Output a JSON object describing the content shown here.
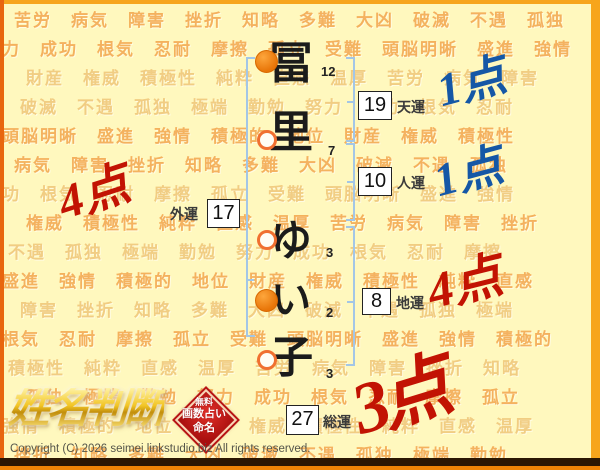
{
  "chart": {
    "characters": [
      {
        "glyph": "冨",
        "strokes": "12",
        "marker": "filled"
      },
      {
        "glyph": "里",
        "strokes": "7",
        "marker": "hollow"
      },
      {
        "glyph": "ゆ",
        "strokes": "3",
        "marker": "hollow"
      },
      {
        "glyph": "い",
        "strokes": "2",
        "marker": "filled"
      },
      {
        "glyph": "子",
        "strokes": "3",
        "marker": "hollow"
      }
    ],
    "fortunes": [
      {
        "key": "tenun",
        "label": "天運",
        "value": "19",
        "score": "1点",
        "score_color": "blue"
      },
      {
        "key": "jinun",
        "label": "人運",
        "value": "10",
        "score": "1点",
        "score_color": "blue"
      },
      {
        "key": "gaiun",
        "label": "外運",
        "value": "17",
        "score": "4点",
        "score_color": "red"
      },
      {
        "key": "chiun",
        "label": "地運",
        "value": "8",
        "score": "4点",
        "score_color": "red"
      },
      {
        "key": "soun",
        "label": "総運",
        "value": "27",
        "score": "3点",
        "score_color": "red"
      }
    ]
  },
  "branding": {
    "logo_text": "姓名判断",
    "seal_lines": [
      "無料",
      "画数占い",
      "命名"
    ]
  },
  "footer": {
    "copyright": "Copyright (C) 2026 seimei.linkstudio.biz All rights reserved."
  },
  "colors": {
    "score_red": "#C21303",
    "score_blue": "#1557A6",
    "bracket_blue": "#A3C6E6",
    "marker_orange": "#E87508",
    "seal_red": "#B81414",
    "logo_gold": "#E8B91C",
    "background": "#FFF8BE"
  },
  "background_words": {
    "rows": [
      "苦労　病気　障害　挫折　知略　多難　大凶　破滅　不遇　孤独",
      "力　成功　根気　忍耐　摩擦　孤立　受難　頭脳明晰　盛進　強情",
      "財産　権威　積極性　純粋　直感　温厚　苦労　病気　障害",
      "破滅　不遇　孤独　極端　勤勉　努力　成功　根気　忍耐",
      "頭脳明晰　盛進　強情　積極的　地位　財産　権威　積極性",
      "病気　障害　挫折　知略　多難　大凶　破滅　不遇　孤独",
      "功　根気　忍耐　摩擦　孤立　受難　頭脳明晰　盛進　強情",
      "権威　積極性　純粋　直感　温厚　苦労　病気　障害　挫折",
      "不遇　孤独　極端　勤勉　努力　成功　根気　忍耐　摩擦",
      "盛進　強情　積極的　地位　財産　権威　積極性　純粋　直感",
      "障害　挫折　知略　多難　大凶　破滅　不遇　孤独　極端",
      "根気　忍耐　摩擦　孤立　受難　頭脳明晰　盛進　強情　積極的",
      "積極性　純粋　直感　温厚　苦労　病気　障害　挫折　知略",
      "孤独　極端　勤勉　努力　成功　根気　忍耐　摩擦　孤立",
      "強情　積極的　地位　財産　権威　積極性　純粋　直感　温厚",
      "挫折　知略　多難　大凶　破滅　不遇　孤独　極端　勤勉"
    ]
  }
}
